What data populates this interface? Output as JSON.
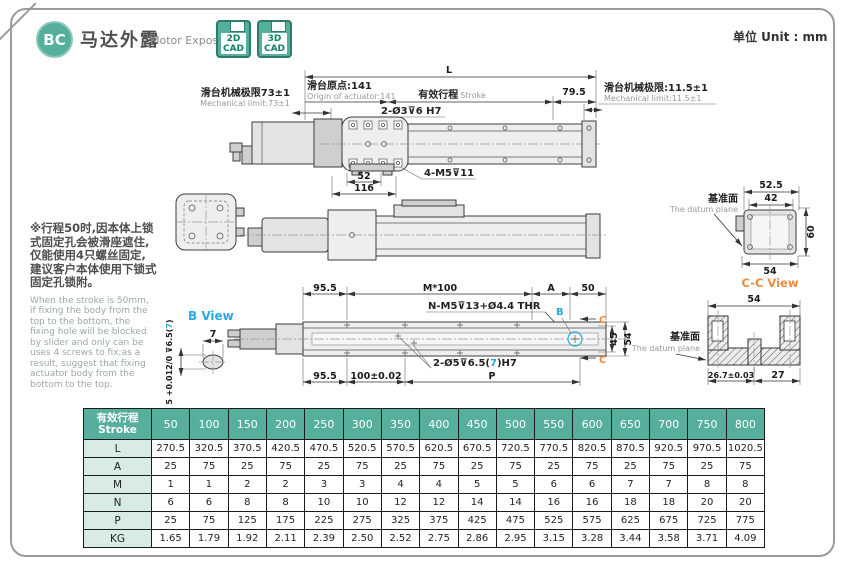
{
  "page": {
    "unit_label": "单位 Unit : mm"
  },
  "header": {
    "badge": "BC",
    "title_zh": "马达外露",
    "title_en": "Motor Exposed",
    "cad_buttons": [
      {
        "line1": "2D",
        "line2": "CAD"
      },
      {
        "line1": "3D",
        "line2": "CAD"
      }
    ]
  },
  "note": {
    "zh": "※行程50时,因本体上锁式固定孔会被滑座遮住,仅能使用4只螺丝固定,建议客户本体使用下锁式固定孔锁附。",
    "en": "When the stroke is 50mm, if fixing the body from the top to the bottom, the fixing hole will be blocked by slider and only can be uses 4 screws to fix;as a result, suggest that fixing actuator body from the bottom to the top."
  },
  "drawing": {
    "top": {
      "L": "L",
      "origin_zh": "滑台原点:141",
      "origin_en": "Origin of actuator:141",
      "stroke_zh": "有效行程",
      "stroke_en": "Stroke",
      "d795": "79.5",
      "mechL_zh": "滑台机械极限73±1",
      "mechL_en": "Mechanical limit:73±1",
      "mechR_zh": "滑台机械极限:11.5±1",
      "mechR_en": "Mechanical limit:11.5±1",
      "hole": "2-Ø3⊽6 H7",
      "d52": "52",
      "d116": "116",
      "screw": "4-M5⊽11"
    },
    "right": {
      "d525": "52.5",
      "d42": "42",
      "d60": "60",
      "d54": "54",
      "datum_zh": "基准面",
      "datum_en": "The datum plane",
      "cc": "C-C View"
    },
    "section": {
      "d54": "54",
      "d267": "26.7±0.03",
      "d27": "27"
    },
    "bottom": {
      "d955": "95.5",
      "m100": "M*100",
      "a": "A",
      "d50": "50",
      "thread": "N-M5⊽13+Ø4.4 THR",
      "pin_pre": "2-Ø5⊽6.5(",
      "pin_mid": "7",
      "pin_post": ")H7",
      "b": "B",
      "c": "C",
      "d45": "45",
      "d54": "54",
      "d955b": "95.5",
      "d100": "100±0.02",
      "p": "P"
    },
    "bview": {
      "label": "B View",
      "d7": "7",
      "tol_pre": "5 +0.012/0 ⊽6.5(",
      "tol_mid": "7",
      "tol_post": ")"
    }
  },
  "table": {
    "header_zh": "有效行程",
    "header_en": "Stroke",
    "strokes": [
      "50",
      "100",
      "150",
      "200",
      "250",
      "300",
      "350",
      "400",
      "450",
      "500",
      "550",
      "600",
      "650",
      "700",
      "750",
      "800"
    ],
    "rows": [
      {
        "label": "L",
        "values": [
          "270.5",
          "320.5",
          "370.5",
          "420.5",
          "470.5",
          "520.5",
          "570.5",
          "620.5",
          "670.5",
          "720.5",
          "770.5",
          "820.5",
          "870.5",
          "920.5",
          "970.5",
          "1020.5"
        ]
      },
      {
        "label": "A",
        "values": [
          "25",
          "75",
          "25",
          "75",
          "25",
          "75",
          "25",
          "75",
          "25",
          "75",
          "25",
          "75",
          "25",
          "75",
          "25",
          "75"
        ]
      },
      {
        "label": "M",
        "values": [
          "1",
          "1",
          "2",
          "2",
          "3",
          "3",
          "4",
          "4",
          "5",
          "5",
          "6",
          "6",
          "7",
          "7",
          "8",
          "8"
        ]
      },
      {
        "label": "N",
        "values": [
          "6",
          "6",
          "8",
          "8",
          "10",
          "10",
          "12",
          "12",
          "14",
          "14",
          "16",
          "16",
          "18",
          "18",
          "20",
          "20"
        ]
      },
      {
        "label": "P",
        "values": [
          "25",
          "75",
          "125",
          "175",
          "225",
          "275",
          "325",
          "375",
          "425",
          "475",
          "525",
          "575",
          "625",
          "675",
          "725",
          "775"
        ]
      },
      {
        "label": "KG",
        "values": [
          "1.65",
          "1.79",
          "1.92",
          "2.11",
          "2.39",
          "2.50",
          "2.52",
          "2.75",
          "2.86",
          "2.95",
          "3.15",
          "3.28",
          "3.44",
          "3.58",
          "3.71",
          "4.09"
        ]
      }
    ]
  },
  "colors": {
    "teal": "#55af9c",
    "orange": "#ef8b3c",
    "blue": "#2aa9e0",
    "row_label_bg": "#d8ece5"
  }
}
